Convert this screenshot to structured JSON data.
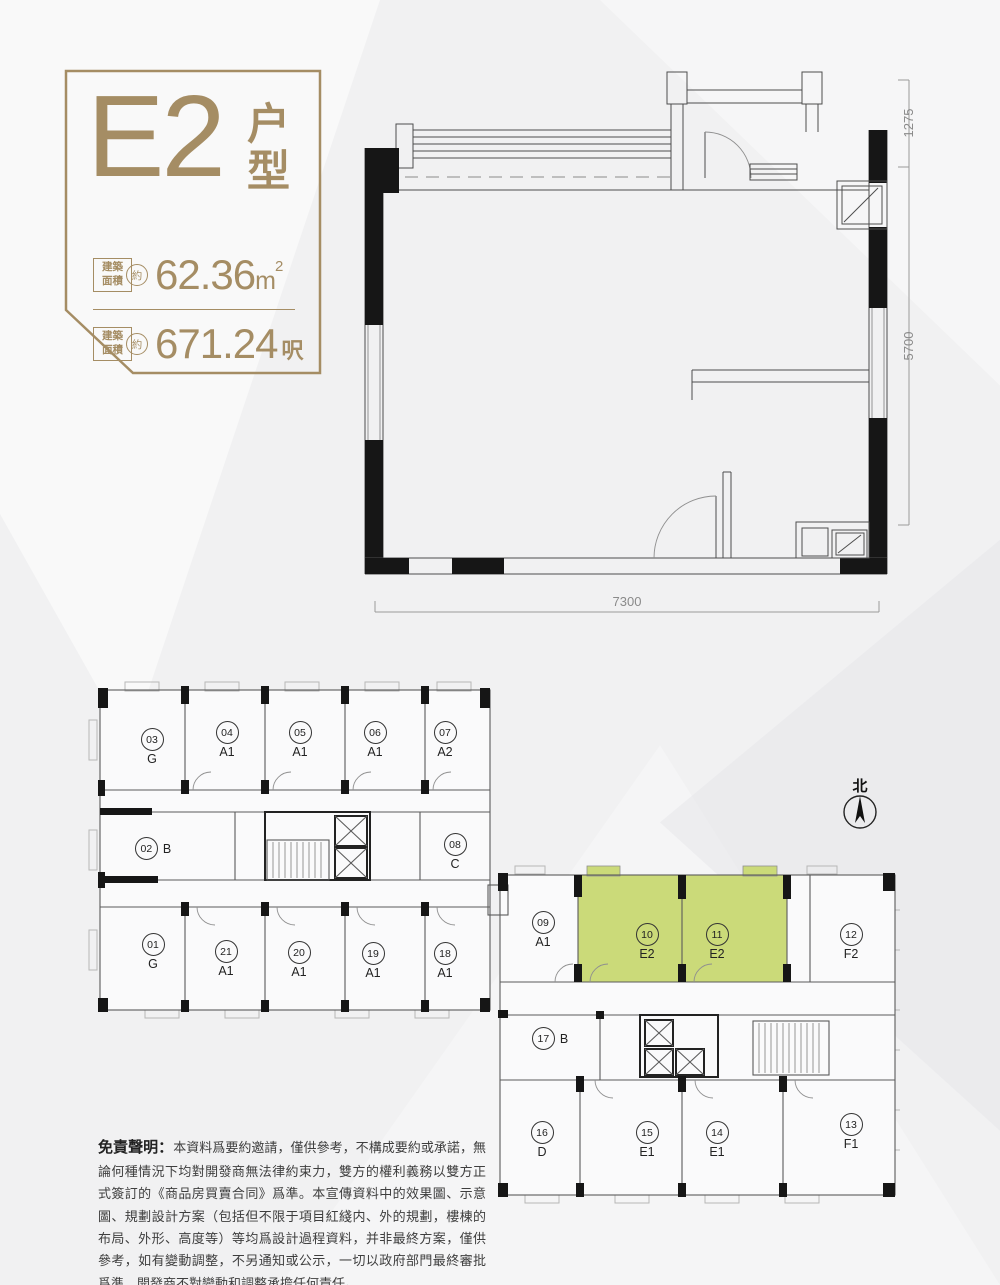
{
  "colors": {
    "gold": "#a58d64",
    "green": "#cbda79"
  },
  "title_card": {
    "unit_code": "E2",
    "unit_type_suffix": "户型",
    "area_rows": [
      {
        "label_top": "建築",
        "label_bottom": "面積",
        "approx": "約",
        "value": "62.36",
        "unit": "m",
        "unit_sup": "2"
      },
      {
        "label_top": "建築",
        "label_bottom": "面積",
        "approx": "約",
        "value": "671.24",
        "unit": "呎",
        "unit_sup": ""
      }
    ]
  },
  "unit_plan": {
    "dim_right_top": "1275",
    "dim_right_main": "5700",
    "dim_bottom": "7300"
  },
  "site_plan": {
    "north_label": "北",
    "units": [
      {
        "no": "03",
        "type": "G",
        "highlight": false
      },
      {
        "no": "04",
        "type": "A1",
        "highlight": false
      },
      {
        "no": "05",
        "type": "A1",
        "highlight": false
      },
      {
        "no": "06",
        "type": "A1",
        "highlight": false
      },
      {
        "no": "07",
        "type": "A2",
        "highlight": false
      },
      {
        "no": "02",
        "type": "B",
        "highlight": false
      },
      {
        "no": "08",
        "type": "C",
        "highlight": false
      },
      {
        "no": "01",
        "type": "G",
        "highlight": false
      },
      {
        "no": "21",
        "type": "A1",
        "highlight": false
      },
      {
        "no": "20",
        "type": "A1",
        "highlight": false
      },
      {
        "no": "19",
        "type": "A1",
        "highlight": false
      },
      {
        "no": "18",
        "type": "A1",
        "highlight": false
      },
      {
        "no": "09",
        "type": "A1",
        "highlight": false
      },
      {
        "no": "10",
        "type": "E2",
        "highlight": true
      },
      {
        "no": "11",
        "type": "E2",
        "highlight": true
      },
      {
        "no": "12",
        "type": "F2",
        "highlight": false
      },
      {
        "no": "17",
        "type": "B",
        "highlight": false
      },
      {
        "no": "16",
        "type": "D",
        "highlight": false
      },
      {
        "no": "15",
        "type": "E1",
        "highlight": false
      },
      {
        "no": "14",
        "type": "E1",
        "highlight": false
      },
      {
        "no": "13",
        "type": "F1",
        "highlight": false
      }
    ]
  },
  "disclaimer": {
    "heading": "免責聲明：",
    "body": "本資料爲要約邀請，僅供參考，不構成要約或承諾，無論何種情況下均對開發商無法律約束力，雙方的權利義務以雙方正式簽訂的《商品房買賣合同》爲準。本宣傳資料中的效果圖、示意圖、規劃設計方案（包括但不限于項目紅綫内、外的規劃，樓棟的布局、外形、高度等）等均爲設計過程資料，并非最終方案，僅供參考，如有變動調整，不另通知或公示，一切以政府部門最終審批爲準，開發商不對變動和調整承擔任何責任。"
  }
}
